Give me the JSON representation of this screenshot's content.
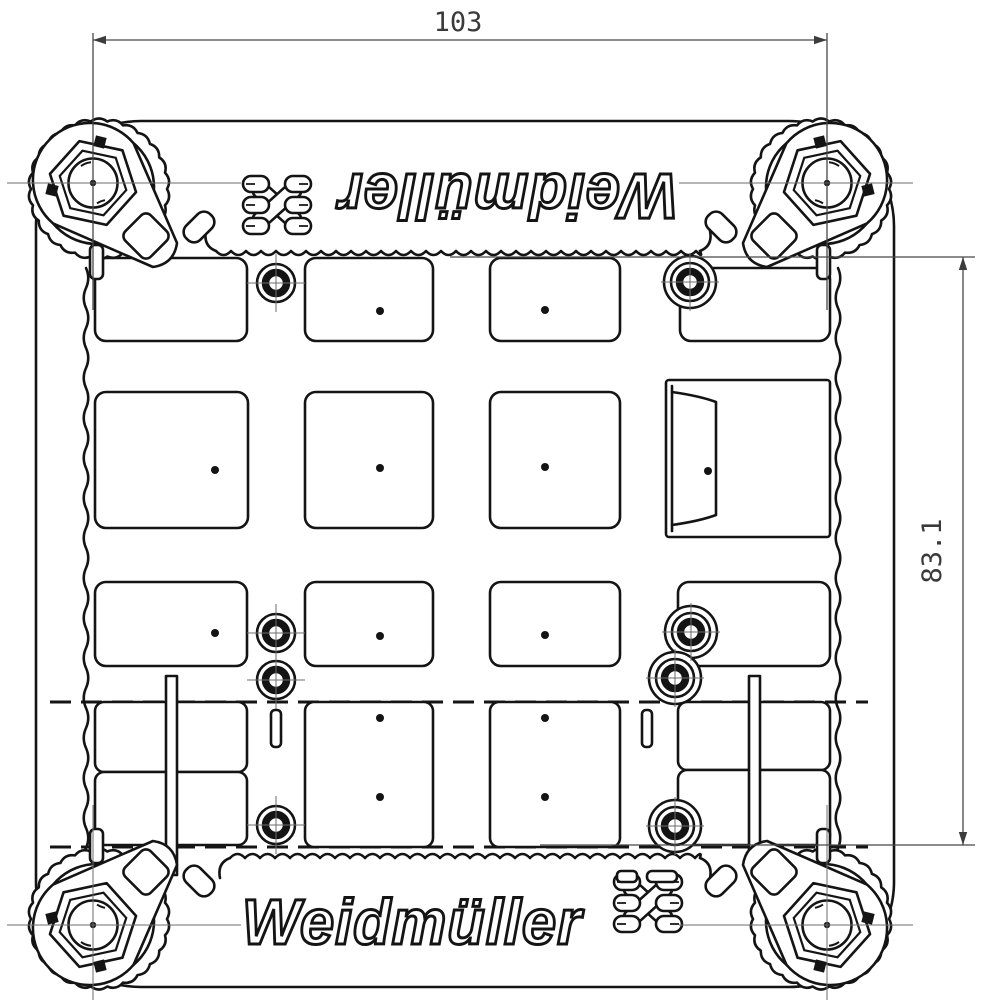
{
  "drawing": {
    "brand": "Weidmüller",
    "dimensions": {
      "width": {
        "label": "103"
      },
      "height": {
        "label": "83.1"
      }
    },
    "colors": {
      "line": "#141414",
      "thin_line": "#474747",
      "centerline": "#6e6e6e",
      "background": "#ffffff"
    }
  }
}
